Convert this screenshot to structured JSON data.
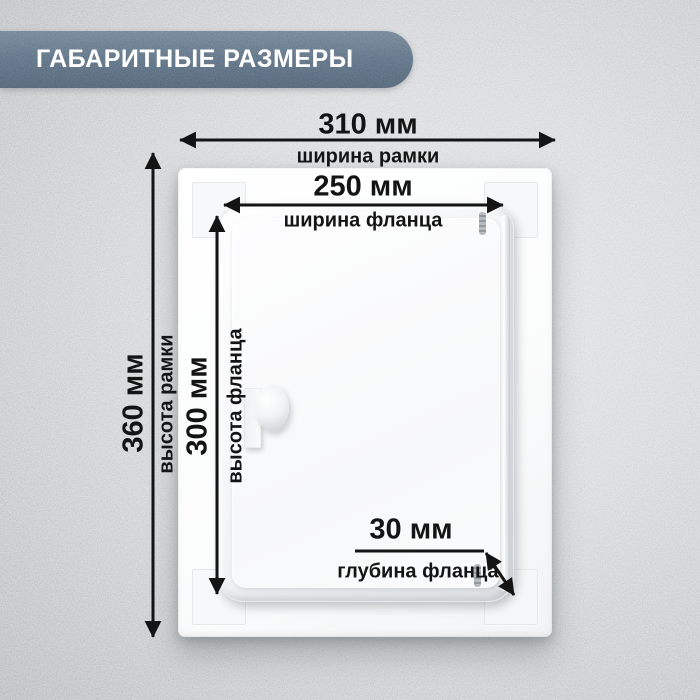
{
  "header": {
    "title": "ГАБАРИТНЫЕ РАЗМЕРЫ"
  },
  "dimensions": {
    "frame_width": {
      "value": "310 мм",
      "label": "ширина рамки"
    },
    "flange_width": {
      "value": "250 мм",
      "label": "ширина фланца"
    },
    "frame_height": {
      "value": "360 мм",
      "label": "высота рамки"
    },
    "flange_height": {
      "value": "300 мм",
      "label": "высота фланца"
    },
    "flange_depth": {
      "value": "30 мм",
      "label": "глубина фланца"
    }
  },
  "colors": {
    "banner": "#5c7084",
    "annotation": "#141414",
    "wall_light": "#e9eaeb",
    "wall_dark": "#b3b7bb",
    "panel": "#fdfdfe"
  }
}
